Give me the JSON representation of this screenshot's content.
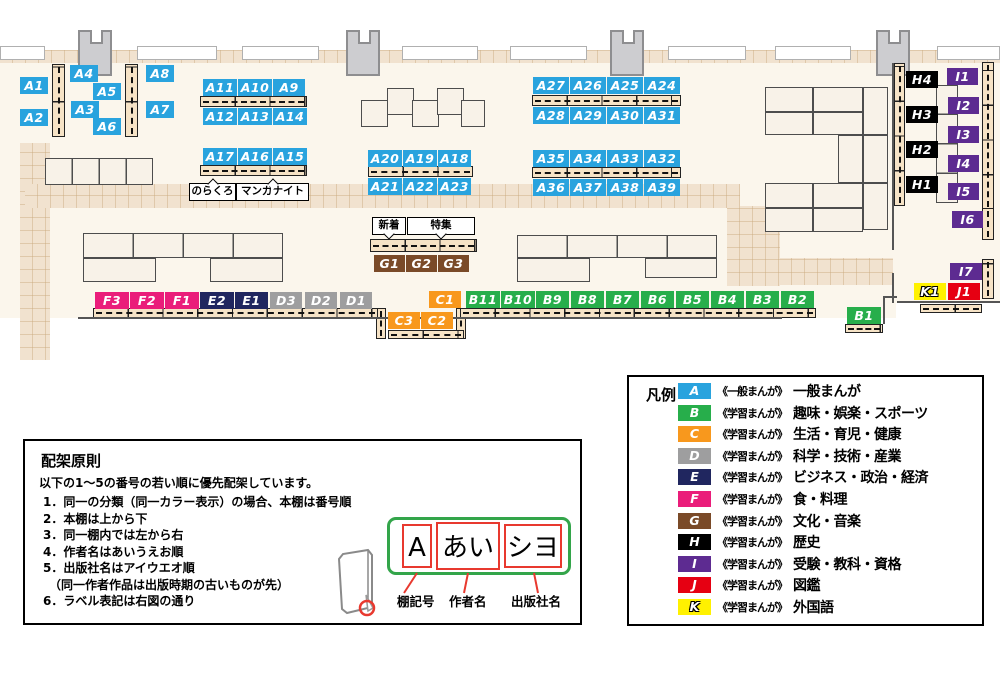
{
  "map": {
    "category_colors": {
      "A": "#29A3DE",
      "B": "#27AE4B",
      "C": "#F8981D",
      "D": "#9E9E9F",
      "E": "#20265F",
      "F": "#EA1D7A",
      "G": "#7A4A28",
      "H": "#000000",
      "I": "#5D2B91",
      "J": "#E60012",
      "K": "#FFF100"
    },
    "labels": [
      {
        "t": "A1",
        "c": "A",
        "x": 20,
        "y": 77,
        "w": 28
      },
      {
        "t": "A2",
        "c": "A",
        "x": 20,
        "y": 109,
        "w": 28
      },
      {
        "t": "A4",
        "c": "A",
        "x": 70,
        "y": 65,
        "w": 28
      },
      {
        "t": "A5",
        "c": "A",
        "x": 93,
        "y": 83,
        "w": 28
      },
      {
        "t": "A3",
        "c": "A",
        "x": 71,
        "y": 101,
        "w": 28
      },
      {
        "t": "A6",
        "c": "A",
        "x": 93,
        "y": 118,
        "w": 28
      },
      {
        "t": "A8",
        "c": "A",
        "x": 146,
        "y": 65,
        "w": 28
      },
      {
        "t": "A7",
        "c": "A",
        "x": 146,
        "y": 101,
        "w": 28
      },
      {
        "t": "A11",
        "c": "A",
        "x": 203,
        "y": 79,
        "w": 34
      },
      {
        "t": "A10",
        "c": "A",
        "x": 238,
        "y": 79,
        "w": 34
      },
      {
        "t": "A9",
        "c": "A",
        "x": 273,
        "y": 79,
        "w": 32
      },
      {
        "t": "A12",
        "c": "A",
        "x": 203,
        "y": 108,
        "w": 34
      },
      {
        "t": "A13",
        "c": "A",
        "x": 238,
        "y": 108,
        "w": 34
      },
      {
        "t": "A14",
        "c": "A",
        "x": 273,
        "y": 108,
        "w": 34
      },
      {
        "t": "A17",
        "c": "A",
        "x": 203,
        "y": 148,
        "w": 34
      },
      {
        "t": "A16",
        "c": "A",
        "x": 238,
        "y": 148,
        "w": 34
      },
      {
        "t": "A15",
        "c": "A",
        "x": 273,
        "y": 148,
        "w": 34
      },
      {
        "t": "A20",
        "c": "A",
        "x": 368,
        "y": 150,
        "w": 34
      },
      {
        "t": "A19",
        "c": "A",
        "x": 403,
        "y": 150,
        "w": 34
      },
      {
        "t": "A18",
        "c": "A",
        "x": 438,
        "y": 150,
        "w": 33
      },
      {
        "t": "A21",
        "c": "A",
        "x": 368,
        "y": 178,
        "w": 34
      },
      {
        "t": "A22",
        "c": "A",
        "x": 403,
        "y": 178,
        "w": 34
      },
      {
        "t": "A23",
        "c": "A",
        "x": 438,
        "y": 178,
        "w": 33
      },
      {
        "t": "A27",
        "c": "A",
        "x": 533,
        "y": 77,
        "w": 36
      },
      {
        "t": "A26",
        "c": "A",
        "x": 570,
        "y": 77,
        "w": 36
      },
      {
        "t": "A25",
        "c": "A",
        "x": 607,
        "y": 77,
        "w": 36
      },
      {
        "t": "A24",
        "c": "A",
        "x": 644,
        "y": 77,
        "w": 36
      },
      {
        "t": "A28",
        "c": "A",
        "x": 533,
        "y": 107,
        "w": 36
      },
      {
        "t": "A29",
        "c": "A",
        "x": 570,
        "y": 107,
        "w": 36
      },
      {
        "t": "A30",
        "c": "A",
        "x": 607,
        "y": 107,
        "w": 36
      },
      {
        "t": "A31",
        "c": "A",
        "x": 644,
        "y": 107,
        "w": 36
      },
      {
        "t": "A35",
        "c": "A",
        "x": 533,
        "y": 150,
        "w": 36
      },
      {
        "t": "A34",
        "c": "A",
        "x": 570,
        "y": 150,
        "w": 36
      },
      {
        "t": "A33",
        "c": "A",
        "x": 607,
        "y": 150,
        "w": 36
      },
      {
        "t": "A32",
        "c": "A",
        "x": 644,
        "y": 150,
        "w": 36
      },
      {
        "t": "A36",
        "c": "A",
        "x": 533,
        "y": 179,
        "w": 36
      },
      {
        "t": "A37",
        "c": "A",
        "x": 570,
        "y": 179,
        "w": 36
      },
      {
        "t": "A38",
        "c": "A",
        "x": 607,
        "y": 179,
        "w": 36
      },
      {
        "t": "A39",
        "c": "A",
        "x": 644,
        "y": 179,
        "w": 36
      },
      {
        "t": "B11",
        "c": "B",
        "x": 466,
        "y": 291,
        "w": 34
      },
      {
        "t": "B10",
        "c": "B",
        "x": 501,
        "y": 291,
        "w": 34
      },
      {
        "t": "B9",
        "c": "B",
        "x": 536,
        "y": 291,
        "w": 33
      },
      {
        "t": "B8",
        "c": "B",
        "x": 571,
        "y": 291,
        "w": 33
      },
      {
        "t": "B7",
        "c": "B",
        "x": 606,
        "y": 291,
        "w": 33
      },
      {
        "t": "B6",
        "c": "B",
        "x": 641,
        "y": 291,
        "w": 33
      },
      {
        "t": "B5",
        "c": "B",
        "x": 676,
        "y": 291,
        "w": 33
      },
      {
        "t": "B4",
        "c": "B",
        "x": 711,
        "y": 291,
        "w": 33
      },
      {
        "t": "B3",
        "c": "B",
        "x": 746,
        "y": 291,
        "w": 33
      },
      {
        "t": "B2",
        "c": "B",
        "x": 781,
        "y": 291,
        "w": 33
      },
      {
        "t": "B1",
        "c": "B",
        "x": 847,
        "y": 307,
        "w": 34
      },
      {
        "t": "C1",
        "c": "C",
        "x": 429,
        "y": 291,
        "w": 32
      },
      {
        "t": "C3",
        "c": "C",
        "x": 388,
        "y": 312,
        "w": 32
      },
      {
        "t": "C2",
        "c": "C",
        "x": 421,
        "y": 312,
        "w": 32
      },
      {
        "t": "D3",
        "c": "D",
        "x": 270,
        "y": 292,
        "w": 32
      },
      {
        "t": "D2",
        "c": "D",
        "x": 305,
        "y": 292,
        "w": 32
      },
      {
        "t": "D1",
        "c": "D",
        "x": 340,
        "y": 292,
        "w": 32
      },
      {
        "t": "E2",
        "c": "E",
        "x": 200,
        "y": 292,
        "w": 34
      },
      {
        "t": "E1",
        "c": "E",
        "x": 235,
        "y": 292,
        "w": 33
      },
      {
        "t": "F3",
        "c": "F",
        "x": 95,
        "y": 292,
        "w": 34
      },
      {
        "t": "F2",
        "c": "F",
        "x": 130,
        "y": 292,
        "w": 34
      },
      {
        "t": "F1",
        "c": "F",
        "x": 165,
        "y": 292,
        "w": 34
      },
      {
        "t": "G1",
        "c": "G",
        "x": 374,
        "y": 255,
        "w": 31
      },
      {
        "t": "G2",
        "c": "G",
        "x": 406,
        "y": 255,
        "w": 31
      },
      {
        "t": "G3",
        "c": "G",
        "x": 438,
        "y": 255,
        "w": 31
      },
      {
        "t": "H4",
        "c": "H",
        "x": 906,
        "y": 71,
        "w": 32
      },
      {
        "t": "H3",
        "c": "H",
        "x": 906,
        "y": 106,
        "w": 32
      },
      {
        "t": "H2",
        "c": "H",
        "x": 906,
        "y": 141,
        "w": 32
      },
      {
        "t": "H1",
        "c": "H",
        "x": 906,
        "y": 176,
        "w": 32
      },
      {
        "t": "I1",
        "c": "I",
        "x": 947,
        "y": 68,
        "w": 31
      },
      {
        "t": "I2",
        "c": "I",
        "x": 948,
        "y": 97,
        "w": 31
      },
      {
        "t": "I3",
        "c": "I",
        "x": 948,
        "y": 126,
        "w": 31
      },
      {
        "t": "I4",
        "c": "I",
        "x": 948,
        "y": 155,
        "w": 31
      },
      {
        "t": "I5",
        "c": "I",
        "x": 948,
        "y": 183,
        "w": 31
      },
      {
        "t": "I6",
        "c": "I",
        "x": 952,
        "y": 211,
        "w": 31
      },
      {
        "t": "I7",
        "c": "I",
        "x": 950,
        "y": 263,
        "w": 32
      },
      {
        "t": "K1",
        "c": "K",
        "x": 914,
        "y": 283,
        "w": 32,
        "outline": true
      },
      {
        "t": "J1",
        "c": "J",
        "x": 948,
        "y": 283,
        "w": 32
      }
    ],
    "annotations": [
      {
        "t": "のらくろ",
        "x": 189,
        "y": 183,
        "w": 45,
        "notch": "top"
      },
      {
        "t": "マンガナイト",
        "x": 236,
        "y": 183,
        "w": 71,
        "notch": "top"
      },
      {
        "t": "新着",
        "x": 372,
        "y": 217,
        "w": 32,
        "notch": "bottom"
      },
      {
        "t": "特集",
        "x": 407,
        "y": 217,
        "w": 66,
        "notch": "bottom"
      }
    ]
  },
  "legend": {
    "title": "凡例",
    "rows": [
      {
        "code": "A",
        "prefix": "《一般まんが》",
        "name": "一般まんが",
        "color": "#29A3DE"
      },
      {
        "code": "B",
        "prefix": "《学習まんが》",
        "name": "趣味・娯楽・スポーツ",
        "color": "#27AE4B"
      },
      {
        "code": "C",
        "prefix": "《学習まんが》",
        "name": "生活・育児・健康",
        "color": "#F8981D"
      },
      {
        "code": "D",
        "prefix": "《学習まんが》",
        "name": "科学・技術・産業",
        "color": "#9E9E9F"
      },
      {
        "code": "E",
        "prefix": "《学習まんが》",
        "name": "ビジネス・政治・経済",
        "color": "#20265F"
      },
      {
        "code": "F",
        "prefix": "《学習まんが》",
        "name": "食・料理",
        "color": "#EA1D7A"
      },
      {
        "code": "G",
        "prefix": "《学習まんが》",
        "name": "文化・音楽",
        "color": "#7A4A28"
      },
      {
        "code": "H",
        "prefix": "《学習まんが》",
        "name": "歴史",
        "color": "#000000"
      },
      {
        "code": "I",
        "prefix": "《学習まんが》",
        "name": "受験・教科・資格",
        "color": "#5D2B91"
      },
      {
        "code": "J",
        "prefix": "《学習まんが》",
        "name": "図鑑",
        "color": "#E60012"
      },
      {
        "code": "K",
        "prefix": "《学習まんが》",
        "name": "外国語",
        "color": "#FFF100",
        "outline": true
      }
    ]
  },
  "principles": {
    "title": "配架原則",
    "intro": "以下の1～5の番号の若い順に優先配架しています。",
    "items": [
      "1．同一の分類（同一カラー表示）の場合、本棚は番号順",
      "2．本棚は上から下",
      "3．同一棚内では左から右",
      "4．作者名はあいうえお順",
      "5．出版社名はアイウエオ順\n　（同一作者作品は出版時期の古いものが先）",
      "6．ラベル表記は右図の通り"
    ],
    "label_example": {
      "parts": [
        "A",
        "あい",
        "シヨ"
      ],
      "captions": [
        "棚記号",
        "作者名",
        "出版社名"
      ]
    }
  }
}
